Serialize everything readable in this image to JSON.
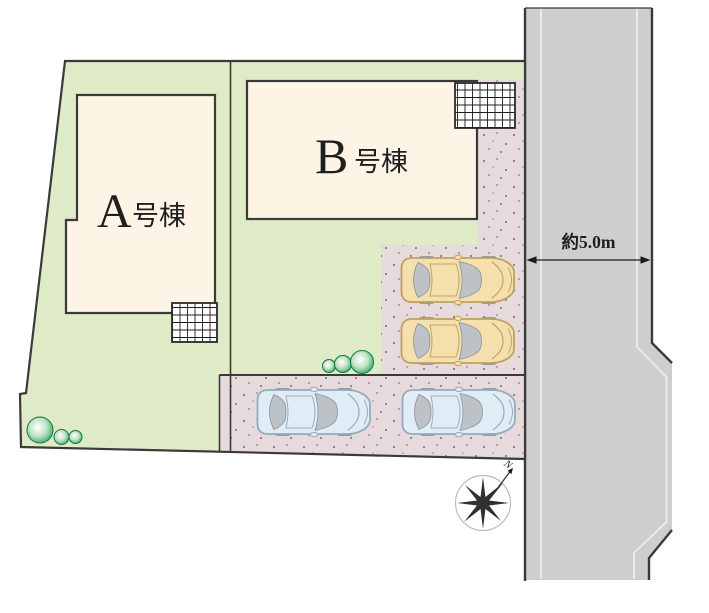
{
  "site_plan": {
    "buildings": {
      "a": {
        "letter": "A",
        "suffix": "号棟",
        "full_label": "A号棟"
      },
      "b": {
        "letter": "B",
        "suffix": "号棟",
        "full_label": "B号棟"
      }
    },
    "road": {
      "width_label": "約5.0m"
    },
    "compass": {
      "north_label": "N"
    },
    "icons": {
      "compass": "compass-rose-icon",
      "bush": "shrub-circle-icon",
      "car": "car-top-view-icon",
      "hatch": "grid-hatch-area"
    }
  },
  "colors": {
    "lot_green": "#dfeac7",
    "building_fill": "#fdf4e5",
    "parking_pink": "#e6dadc",
    "road_gray": "#cdced0",
    "road_lane": "#e9eaeb",
    "outline": "#3a3a3a",
    "bush_green": "#18944e",
    "speckle": "#5f5558",
    "car_beige_body": "#f5e0ad",
    "car_beige_trim": "#bfa05f",
    "car_blue_body": "#e0edf7",
    "car_blue_trim": "#94abbb",
    "car_glass": "#bcc2c6"
  }
}
